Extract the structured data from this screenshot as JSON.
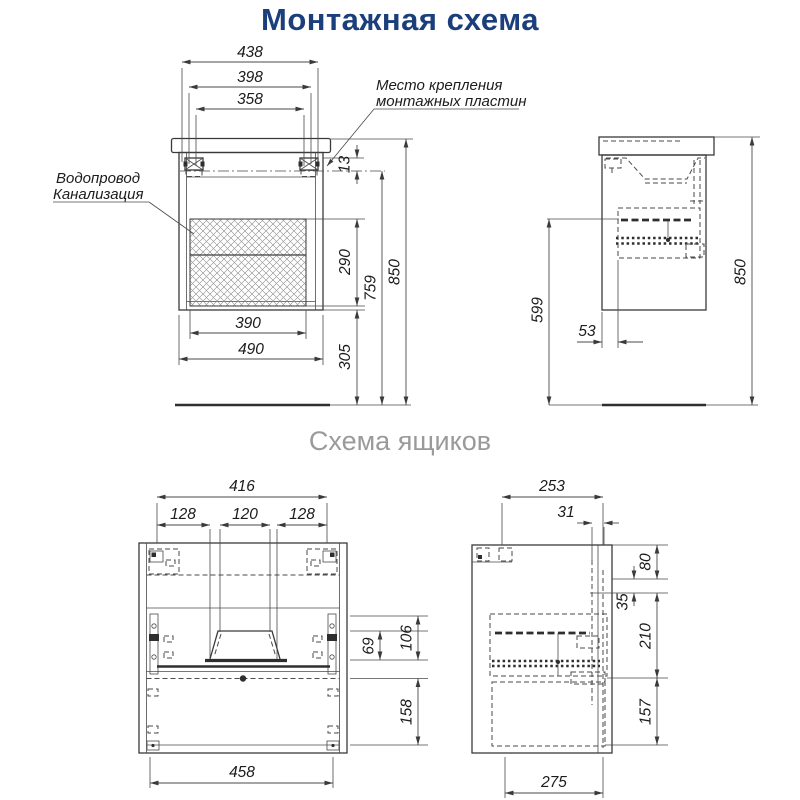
{
  "title": "Монтажная схема",
  "subtitle": "Схема ящиков",
  "colors": {
    "title_blue": "#1b3e7c",
    "subtitle_gray": "#9a9a9a",
    "line_dark": "#3a3a3a"
  },
  "annotations": {
    "mounting_plates_line1": "Место крепления",
    "mounting_plates_line2": "монтажных пластин",
    "plumbing_line1": "Водопровод",
    "plumbing_line2": "Канализация"
  },
  "mounting_front": {
    "width_top": "438",
    "width_mid": "398",
    "width_inner": "358",
    "plate_offset": "13",
    "hatch_height": "290",
    "plate_to_floor": "759",
    "total_height": "850",
    "floor_clearance": "305",
    "hatch_width": "390",
    "cabinet_width": "490"
  },
  "mounting_side": {
    "slide_to_floor": "599",
    "back_offset": "53",
    "total_height": "850"
  },
  "drawers_front": {
    "inner_width": "416",
    "left_section": "128",
    "center_section": "120",
    "right_section": "128",
    "recess_height": "69",
    "upper_front_height": "106",
    "lower_front_height": "158",
    "outer_width": "458"
  },
  "drawers_side": {
    "depth": "253",
    "front_offset": "31",
    "top_gap": "80",
    "rail_gap": "35",
    "upper_drawer_height": "210",
    "lower_drawer_height": "157",
    "bottom_depth": "275"
  }
}
